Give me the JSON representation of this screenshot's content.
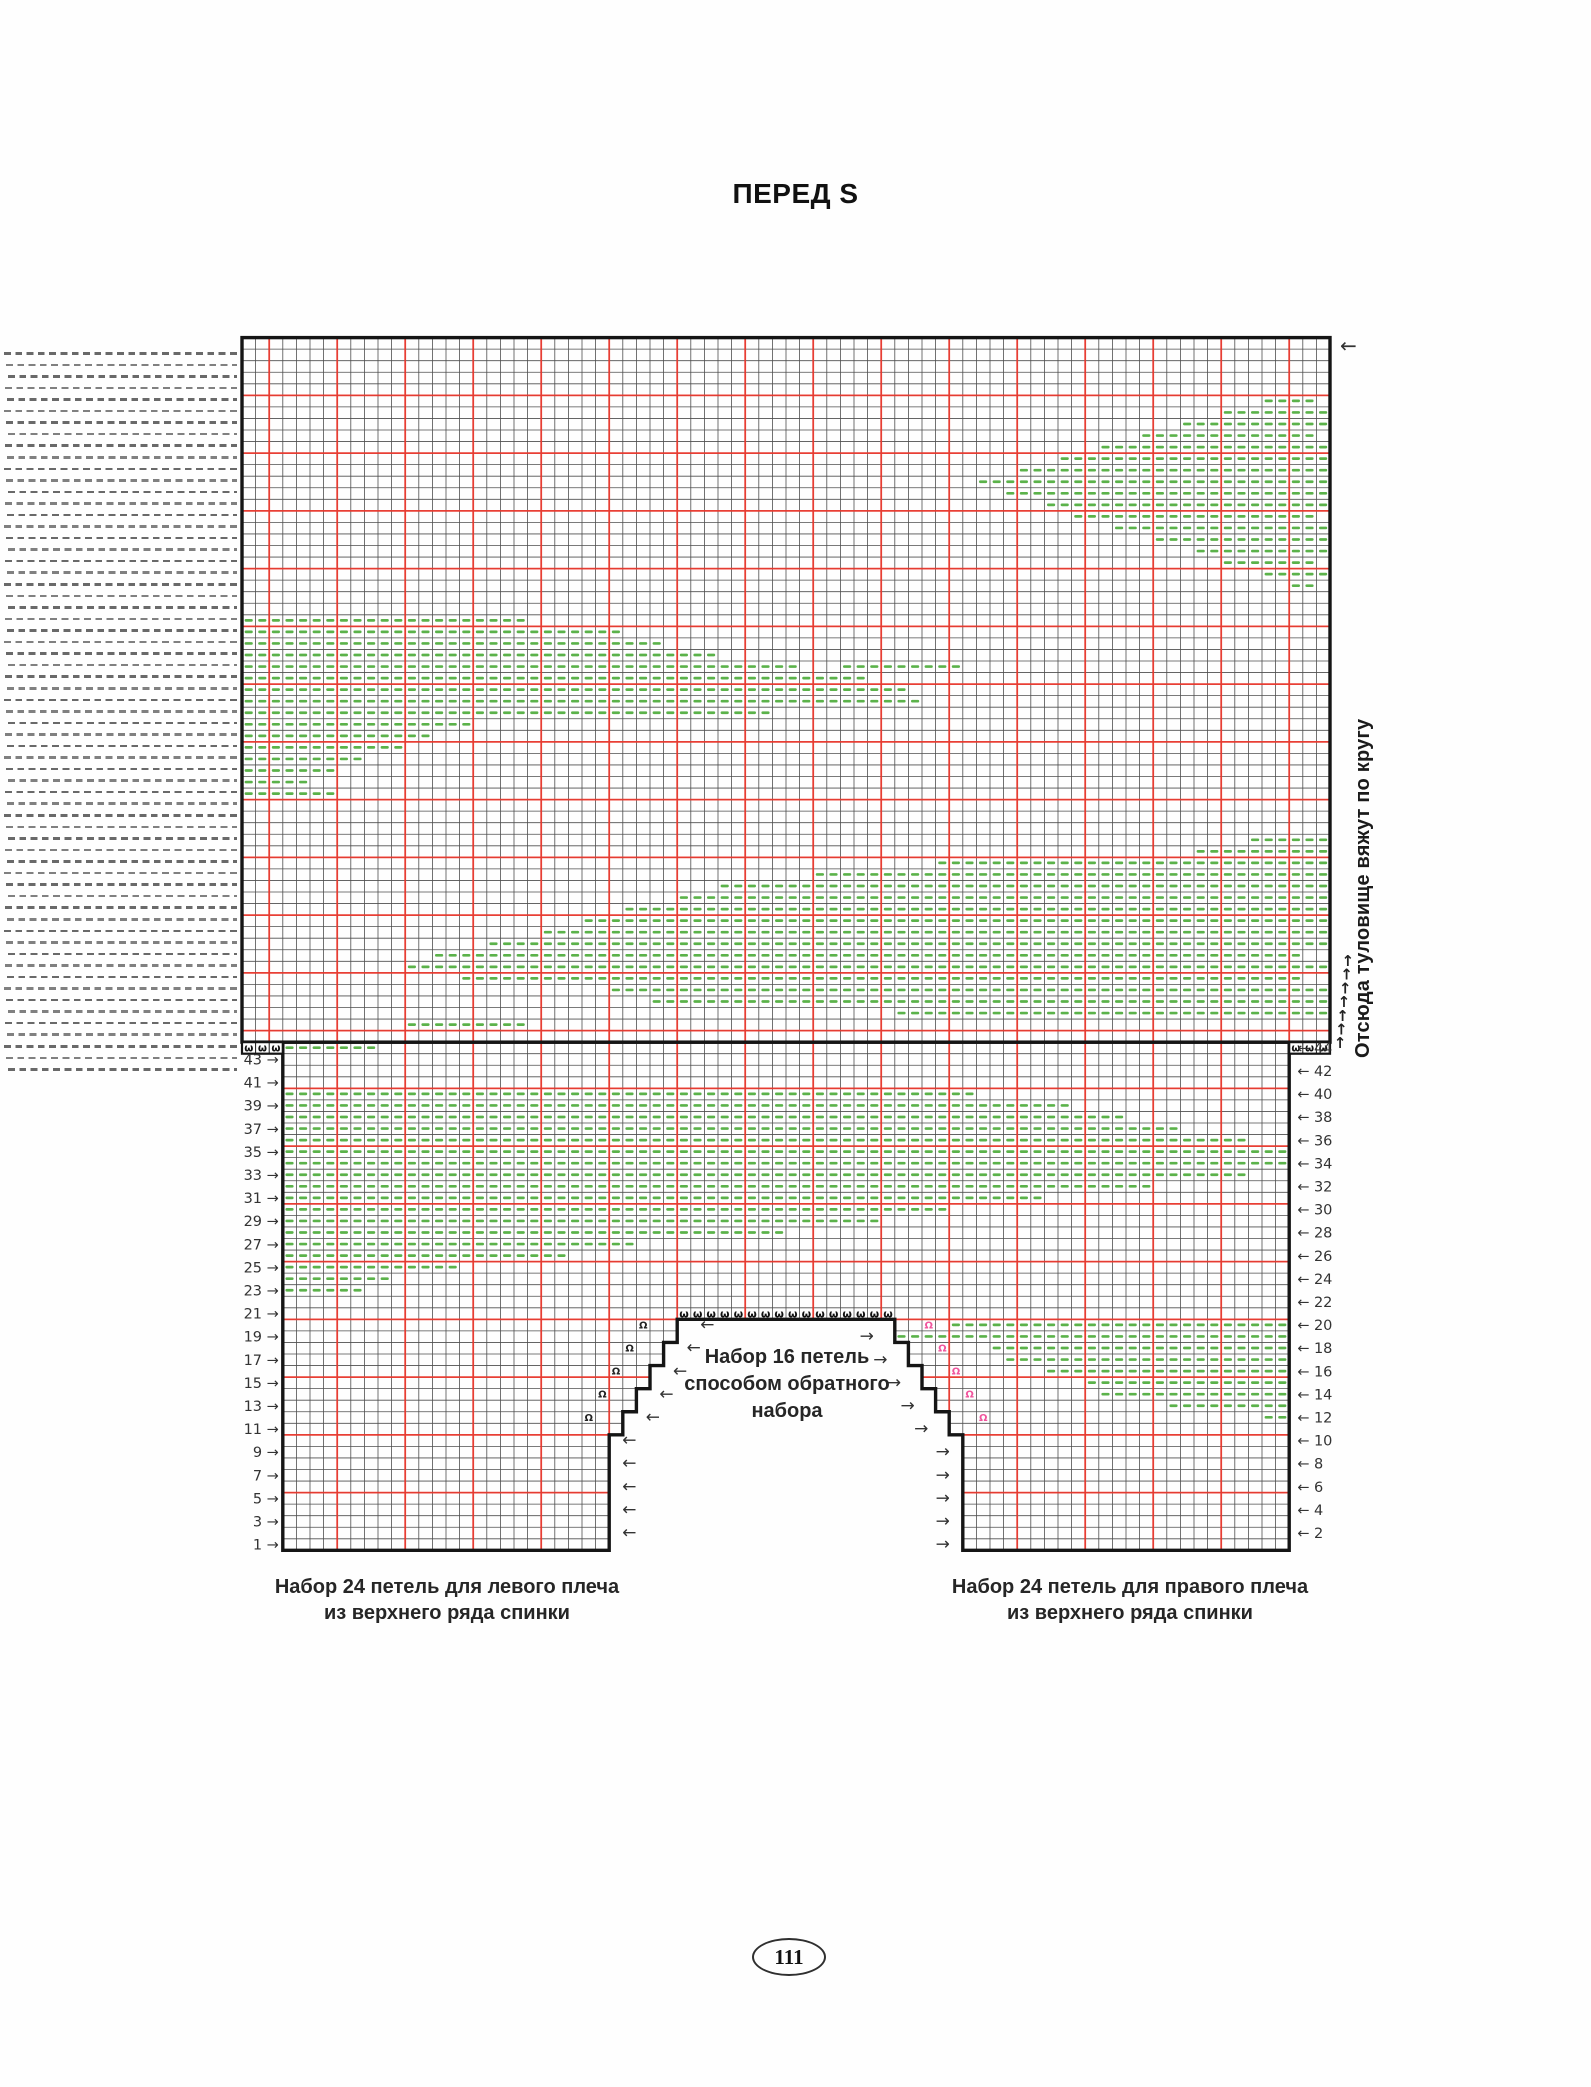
{
  "page": {
    "title": "ПЕРЕД S",
    "page_number": "111"
  },
  "labels": {
    "neck_caston": "Набор 16 петель\nспособом обратного\nнабора",
    "left_shoulder": "Набор 24 петель для левого плеча\nиз верхнего ряда спинки",
    "right_shoulder": "Набор 24 петель для правого плеча\nиз верхнего ряда спинки",
    "in_the_round": "Отсюда туловище вяжут по кругу"
  },
  "colors": {
    "red": "#ee362b",
    "green": "#5bb24a",
    "black": "#151515",
    "pink": "#f0549c",
    "grid": "#4e4e4e",
    "number": "#333333"
  },
  "chart_data": {
    "type": "knitting-chart",
    "grid": {
      "origin_x": 242,
      "origin_y": 337.6,
      "cell_w": 13.6,
      "row_h": 11.55,
      "upper_cols": 80,
      "upper_rows": 61,
      "band_rows": 24,
      "shoulder_rows": 20,
      "lower_inset_cols": 3,
      "shoulder_sts": 24,
      "neck_steps": 5,
      "neck_caston_sts": 16,
      "numbered_rows": 44,
      "red_col_offset": 2,
      "red_step": 5
    },
    "row_numbers_left": [
      43,
      41,
      39,
      37,
      35,
      33,
      31,
      29,
      27,
      25,
      23,
      21,
      19,
      17,
      15,
      13,
      11,
      9,
      7,
      5,
      3,
      1
    ],
    "row_numbers_right": [
      44,
      42,
      40,
      38,
      36,
      34,
      32,
      30,
      28,
      26,
      24,
      22,
      20,
      18,
      16,
      14,
      12,
      10,
      8,
      6,
      4,
      2
    ],
    "symbols": {
      "caston": "ω",
      "increase": "Ω",
      "arrow_left": "←",
      "arrow_right": "→",
      "arrow_up": "↑"
    },
    "increases": {
      "rows": [
        12,
        14,
        16,
        18,
        20
      ],
      "left_cols": [
        25,
        26,
        27,
        28,
        29
      ],
      "right_cols": [
        54,
        53,
        52,
        51,
        50
      ]
    },
    "arrows": {
      "left_rows": [
        2,
        4,
        6,
        8,
        10,
        12,
        14,
        16,
        18,
        20
      ],
      "right_rows": [
        1,
        3,
        5,
        7,
        9,
        11,
        13,
        15,
        17,
        19
      ],
      "up_count": 7
    },
    "purl_runs": [
      [
        5,
        75,
        78
      ],
      [
        6,
        72,
        79
      ],
      [
        7,
        69,
        79
      ],
      [
        8,
        66,
        78
      ],
      [
        9,
        63,
        79
      ],
      [
        10,
        60,
        79
      ],
      [
        11,
        57,
        79
      ],
      [
        12,
        54,
        79
      ],
      [
        13,
        56,
        79
      ],
      [
        14,
        59,
        79
      ],
      [
        15,
        61,
        78
      ],
      [
        16,
        64,
        79
      ],
      [
        17,
        67,
        79
      ],
      [
        18,
        70,
        79
      ],
      [
        19,
        72,
        78
      ],
      [
        20,
        75,
        79
      ],
      [
        21,
        77,
        78
      ],
      [
        24,
        0,
        20
      ],
      [
        25,
        0,
        27
      ],
      [
        26,
        0,
        30
      ],
      [
        27,
        0,
        34
      ],
      [
        28,
        0,
        40
      ],
      [
        28,
        44,
        52
      ],
      [
        29,
        0,
        45
      ],
      [
        30,
        0,
        48
      ],
      [
        31,
        0,
        49
      ],
      [
        32,
        0,
        38
      ],
      [
        33,
        0,
        16
      ],
      [
        34,
        0,
        13
      ],
      [
        35,
        0,
        11
      ],
      [
        36,
        0,
        8
      ],
      [
        37,
        0,
        6
      ],
      [
        38,
        0,
        4
      ],
      [
        39,
        0,
        6
      ],
      [
        43,
        74,
        79
      ],
      [
        44,
        70,
        79
      ],
      [
        45,
        51,
        79
      ],
      [
        46,
        42,
        79
      ],
      [
        47,
        35,
        79
      ],
      [
        48,
        32,
        79
      ],
      [
        49,
        28,
        79
      ],
      [
        50,
        25,
        79
      ],
      [
        51,
        22,
        79
      ],
      [
        52,
        18,
        79
      ],
      [
        53,
        14,
        77
      ],
      [
        54,
        12,
        79
      ],
      [
        55,
        16,
        77
      ],
      [
        56,
        27,
        79
      ],
      [
        57,
        30,
        79
      ],
      [
        58,
        48,
        79
      ],
      [
        59,
        12,
        20
      ],
      [
        61,
        3,
        9
      ],
      [
        65,
        3,
        53
      ],
      [
        66,
        3,
        60
      ],
      [
        67,
        3,
        64
      ],
      [
        68,
        3,
        68
      ],
      [
        69,
        3,
        73
      ],
      [
        70,
        3,
        76
      ],
      [
        71,
        3,
        76
      ],
      [
        72,
        3,
        73
      ],
      [
        73,
        3,
        66
      ],
      [
        74,
        3,
        58
      ],
      [
        75,
        3,
        51
      ],
      [
        76,
        3,
        46
      ],
      [
        77,
        3,
        39
      ],
      [
        78,
        3,
        28
      ],
      [
        79,
        3,
        23
      ],
      [
        80,
        3,
        15
      ],
      [
        81,
        3,
        10
      ],
      [
        82,
        3,
        8
      ],
      [
        85,
        52,
        76
      ],
      [
        86,
        48,
        76
      ],
      [
        87,
        55,
        76
      ],
      [
        88,
        56,
        76
      ],
      [
        89,
        59,
        76
      ],
      [
        90,
        62,
        76
      ],
      [
        91,
        63,
        76
      ],
      [
        92,
        68,
        76
      ],
      [
        93,
        75,
        76
      ]
    ],
    "faded_left_panel": {
      "rows": 63,
      "note": "continuation dashes of adjacent chart page"
    }
  }
}
